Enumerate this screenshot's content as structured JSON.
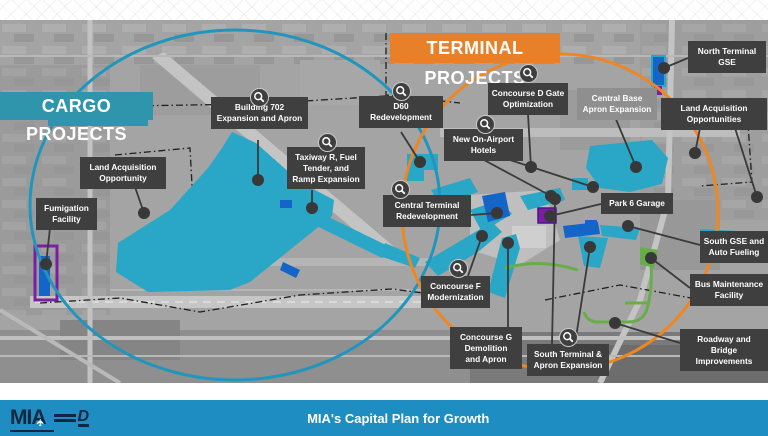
{
  "banners": {
    "cargo": {
      "label": "CARGO PROJECTS",
      "color": "#2f95ad"
    },
    "terminal": {
      "label": "TERMINAL PROJECTS",
      "color": "#e8802a"
    }
  },
  "footer": {
    "bar_color": "#1e8dc1",
    "title": "MIA's Capital Plan for Growth",
    "mia_logo_text": "MIA",
    "county_logo_text": "D"
  },
  "map": {
    "colors": {
      "teal_area": "#2aa6c6",
      "blue_area": "#1565c8",
      "purple_area": "#7b1fa2",
      "green_area": "#67ae4a",
      "cargo_circle": "#2196bd",
      "terminal_circle": "#ee8722",
      "label_dark": "#3f3f3f",
      "label_light": "#8f8f8f",
      "leader": "#3a3a3a",
      "dot": "#383838"
    },
    "labels": [
      {
        "id": "building-702",
        "lines": [
          "Building 702",
          "Expansion and Apron"
        ],
        "x": 211,
        "y": 97,
        "w": 97,
        "variant": "dark",
        "icon": [
          259,
          97
        ],
        "leaders": [
          [
            258,
            140,
            258,
            180
          ]
        ]
      },
      {
        "id": "taxiway-r",
        "lines": [
          "Taxiway R, Fuel",
          "Tender, and",
          "Ramp Expansion"
        ],
        "x": 287,
        "y": 147,
        "w": 78,
        "variant": "dark",
        "icon": [
          327,
          142
        ],
        "leaders": [
          [
            312,
            190,
            312,
            208
          ]
        ]
      },
      {
        "id": "d60-redevelopment",
        "lines": [
          "D60",
          "Redevelopment"
        ],
        "x": 359,
        "y": 96,
        "w": 84,
        "variant": "dark",
        "icon": [
          401,
          91
        ],
        "leaders": [
          [
            401,
            132,
            420,
            162
          ]
        ]
      },
      {
        "id": "concourse-d-gate",
        "lines": [
          "Concourse D Gate",
          "Optimization"
        ],
        "x": 488,
        "y": 83,
        "w": 80,
        "variant": "dark",
        "icon": [
          528,
          73
        ],
        "leaders": [
          [
            528,
            114,
            531,
            167
          ]
        ]
      },
      {
        "id": "new-on-airport-hotels",
        "lines": [
          "New On-Airport",
          "Hotels"
        ],
        "x": 444,
        "y": 129,
        "w": 79,
        "variant": "dark",
        "icon": [
          485,
          124
        ],
        "leaders": [
          [
            484,
            160,
            551,
            196
          ],
          [
            510,
            160,
            593,
            187
          ]
        ]
      },
      {
        "id": "central-base-apron",
        "lines": [
          "Central Base",
          "Apron Expansion"
        ],
        "x": 577,
        "y": 88,
        "w": 80,
        "variant": "light",
        "icon": null,
        "leaders": [
          [
            615,
            117,
            636,
            167
          ]
        ]
      },
      {
        "id": "north-terminal-gse",
        "lines": [
          "North Terminal",
          "GSE"
        ],
        "x": 688,
        "y": 41,
        "w": 78,
        "variant": "dark",
        "icon": null,
        "leaders": [
          [
            688,
            58,
            664,
            68
          ]
        ]
      },
      {
        "id": "land-acquisition-opportunities",
        "lines": [
          "Land Acquisition",
          "Opportunities"
        ],
        "x": 661,
        "y": 98,
        "w": 106,
        "variant": "dark",
        "icon": null,
        "leaders": [
          [
            700,
            128,
            695,
            153
          ],
          [
            735,
            128,
            757,
            197
          ]
        ]
      },
      {
        "id": "park-6-garage",
        "lines": [
          "Park 6 Garage"
        ],
        "x": 601,
        "y": 193,
        "w": 72,
        "variant": "dark",
        "icon": null,
        "leaders": [
          [
            601,
            204,
            550,
            216
          ]
        ]
      },
      {
        "id": "land-acquisition-opportunity",
        "lines": [
          "Land Acquisition",
          "Opportunity"
        ],
        "x": 80,
        "y": 157,
        "w": 86,
        "variant": "dark",
        "icon": null,
        "leaders": [
          [
            135,
            187,
            144,
            213
          ]
        ]
      },
      {
        "id": "fumigation-facility",
        "lines": [
          "Fumigation",
          "Facility"
        ],
        "x": 36,
        "y": 198,
        "w": 61,
        "variant": "dark",
        "icon": null,
        "leaders": [
          [
            50,
            228,
            46,
            264
          ]
        ]
      },
      {
        "id": "central-terminal",
        "lines": [
          "Central Terminal",
          "Redevelopment"
        ],
        "x": 383,
        "y": 195,
        "w": 88,
        "variant": "dark",
        "icon": [
          400,
          189
        ],
        "leaders": [
          [
            471,
            215,
            497,
            213
          ]
        ]
      },
      {
        "id": "concourse-f",
        "lines": [
          "Concourse F",
          "Modernization"
        ],
        "x": 421,
        "y": 276,
        "w": 69,
        "variant": "dark",
        "icon": [
          458,
          268
        ],
        "leaders": [
          [
            468,
            276,
            482,
            236
          ]
        ]
      },
      {
        "id": "concourse-g",
        "lines": [
          "Concourse G",
          "Demolition",
          "and Apron"
        ],
        "x": 450,
        "y": 327,
        "w": 72,
        "variant": "dark",
        "icon": null,
        "leaders": [
          [
            508,
            327,
            508,
            243
          ]
        ]
      },
      {
        "id": "south-terminal-apron",
        "lines": [
          "South Terminal &",
          "Apron Expansion"
        ],
        "x": 527,
        "y": 344,
        "w": 82,
        "variant": "dark",
        "icon": [
          568,
          337
        ],
        "leaders": [
          [
            575,
            344,
            590,
            247
          ],
          [
            552,
            344,
            555,
            199
          ]
        ]
      },
      {
        "id": "south-gse-auto-fueling",
        "lines": [
          "South GSE and",
          "Auto Fueling"
        ],
        "x": 700,
        "y": 231,
        "w": 68,
        "variant": "dark",
        "icon": null,
        "leaders": [
          [
            700,
            245,
            628,
            226
          ]
        ]
      },
      {
        "id": "bus-maintenance",
        "lines": [
          "Bus Maintenance",
          "Facility"
        ],
        "x": 690,
        "y": 274,
        "w": 78,
        "variant": "dark",
        "icon": null,
        "leaders": [
          [
            690,
            288,
            651,
            258
          ]
        ]
      },
      {
        "id": "roadway-bridge",
        "lines": [
          "Roadway and Bridge",
          "Improvements"
        ],
        "x": 680,
        "y": 329,
        "w": 88,
        "variant": "dark",
        "icon": null,
        "leaders": [
          [
            680,
            343,
            615,
            323
          ]
        ]
      }
    ]
  }
}
